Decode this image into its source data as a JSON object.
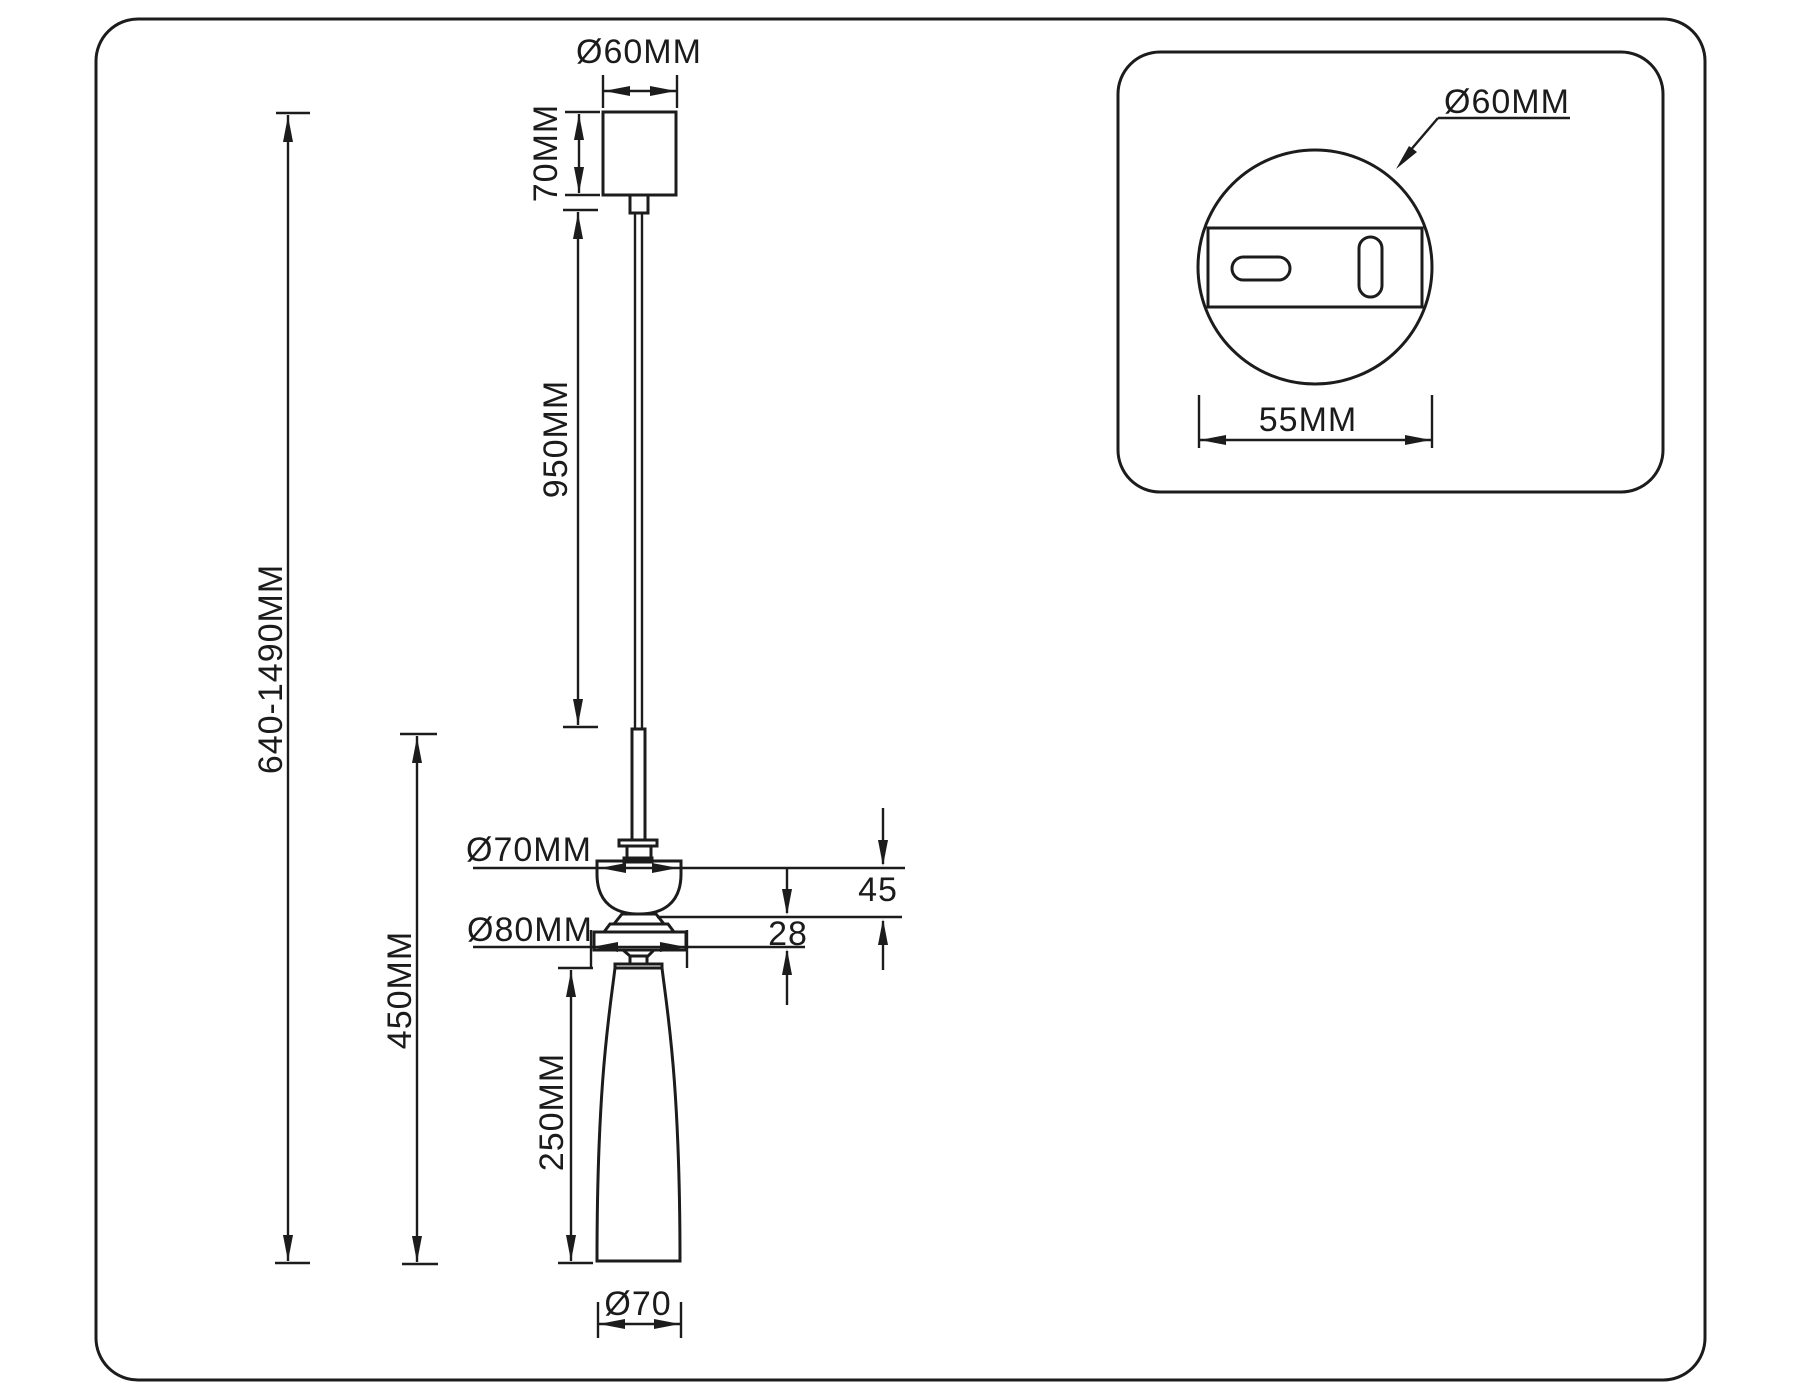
{
  "title": "Pendant lamp technical dimension drawing",
  "colors": {
    "line": "#1c1c1c",
    "background": "#ffffff"
  },
  "labels": {
    "canopy_diameter": "Ø60MM",
    "canopy_height": "70MM",
    "cable_length": "950MM",
    "overall_height": "640-1490MM",
    "fixture_height": "450MM",
    "shade_height": "250MM",
    "holder_diameter": "Ø70MM",
    "disc_diameter": "Ø80MM",
    "holder_depth": "45",
    "disc_depth": "28",
    "shade_bottom_diameter": "Ø70"
  },
  "inset": {
    "canopy_plate_diameter": "Ø60MM",
    "plate_width": "55MM"
  }
}
